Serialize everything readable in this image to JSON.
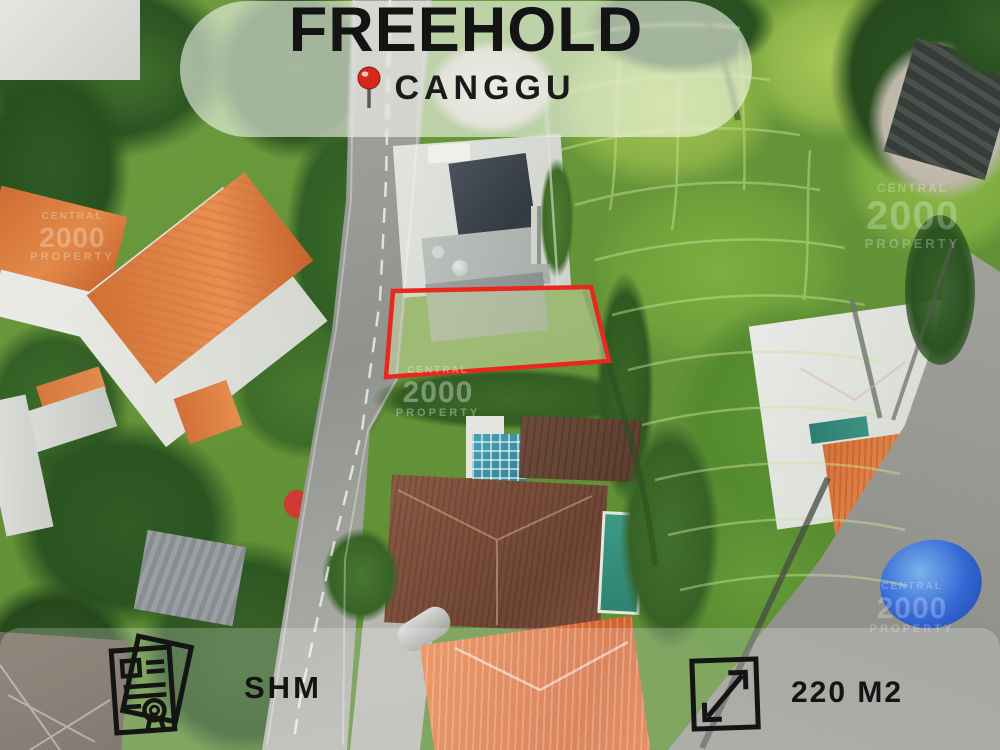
{
  "banner": {
    "title": "FREEHOLD",
    "location": "CANGGU",
    "pin_icon": "round-pushpin"
  },
  "footer": {
    "certificate_label": "SHM",
    "size_label": "220 M2",
    "certificate_icon": "land-certificate-document",
    "size_icon": "area-expand-arrow"
  },
  "watermark": {
    "line1": "CENTRAL",
    "line2": "2000",
    "line3": "PROPERTY"
  },
  "plot": {
    "outline_color": "#e8271d"
  },
  "colors": {
    "plot_outline": "#e8271d",
    "pin_red": "#e23727",
    "heading_text": "#141414",
    "banner_bg": "rgba(250,251,244,0.58)",
    "footer_bg": "rgba(255,255,255,0.22)"
  }
}
